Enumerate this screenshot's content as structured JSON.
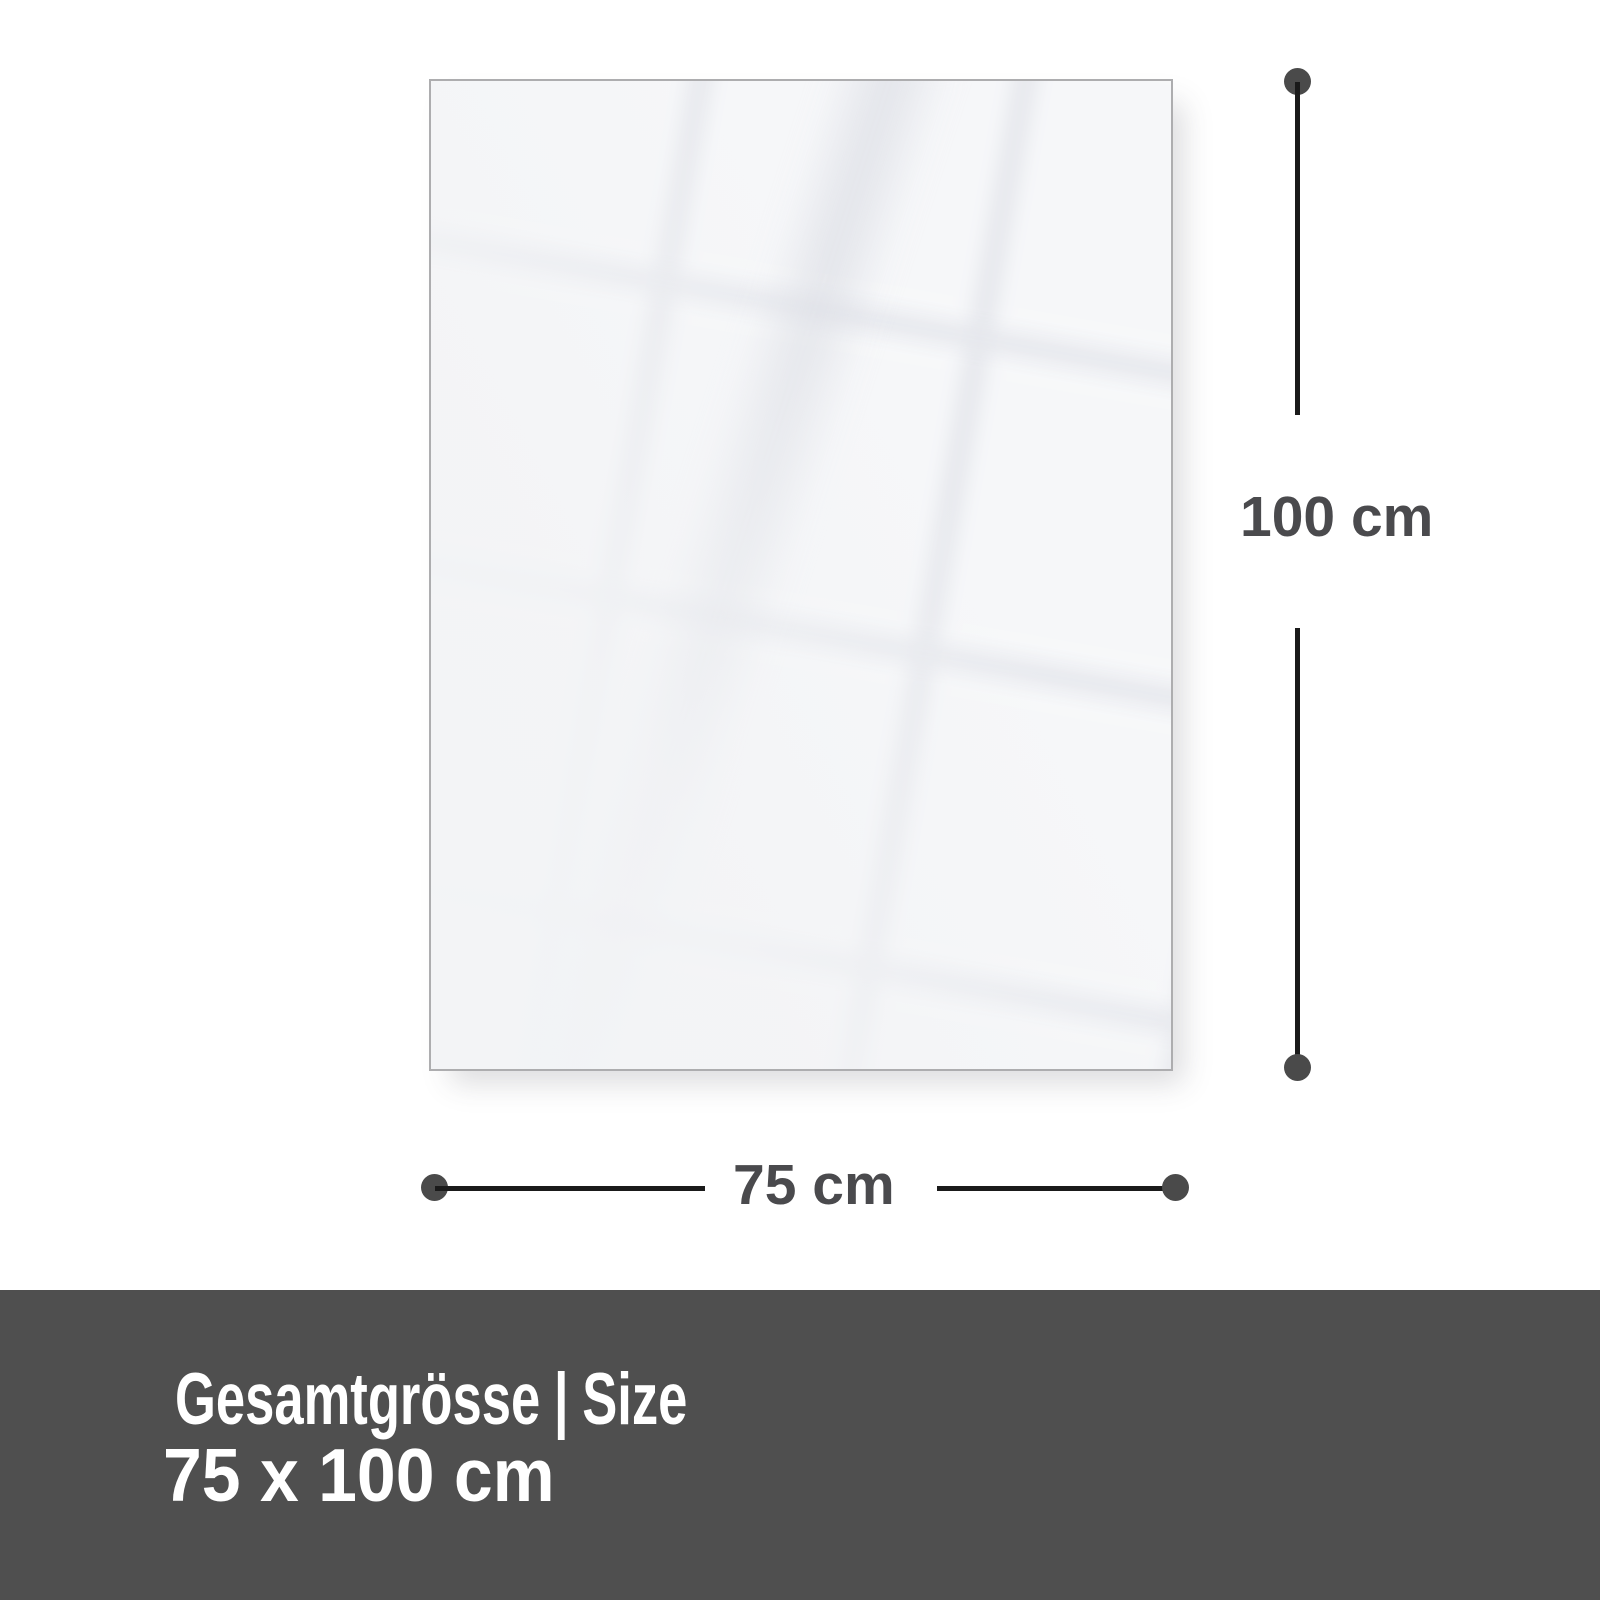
{
  "diagram": {
    "dimensions": {
      "height_label": "100 cm",
      "width_label": "75 cm"
    }
  },
  "footer": {
    "title_de": "Gesamtgrösse",
    "divider": "|",
    "title_en": "Size",
    "size_text": "75 x 100 cm"
  },
  "theme": {
    "page-bg": "#ffffff",
    "panel-fill": "#f3f4f6",
    "panel-border": "#adadaf",
    "dim-line": "#1a1a1a",
    "dim-dot": "#4a4a4a",
    "dim-text": "#4a4a4d",
    "footer-bg": "#4f4f4f",
    "footer-text": "#ffffff"
  }
}
